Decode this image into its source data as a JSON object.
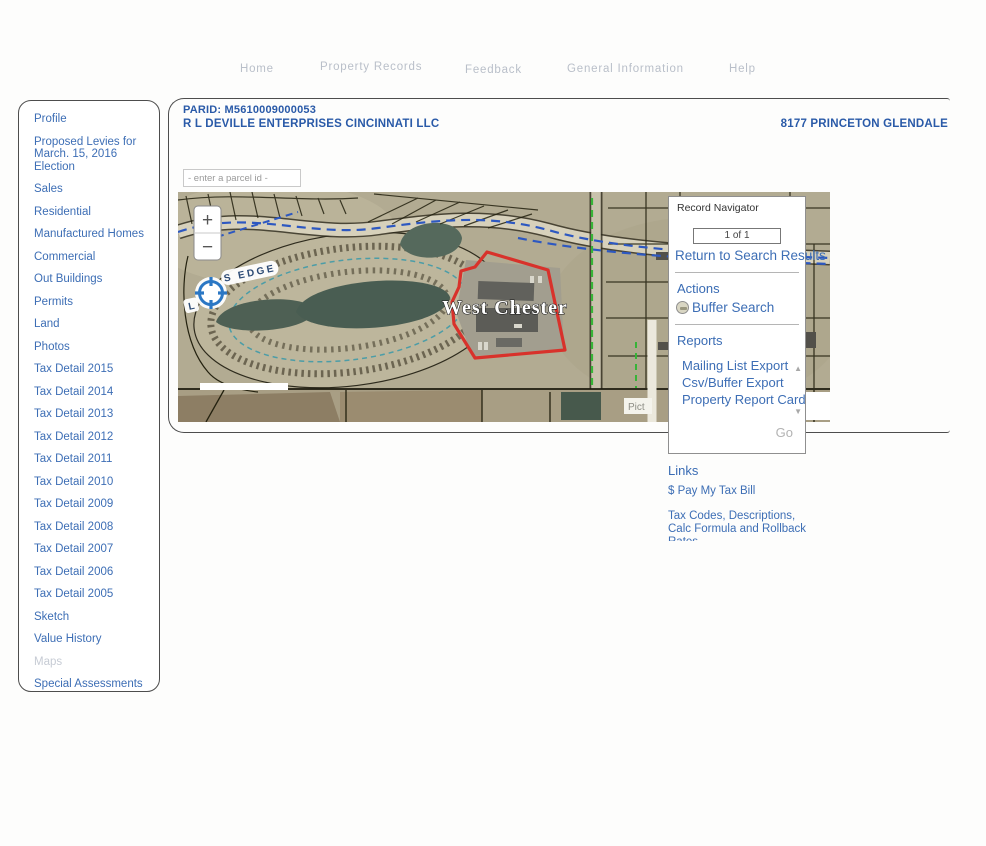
{
  "nav": {
    "items": [
      "Home",
      "Property Records",
      "Feedback",
      "General Information",
      "Help"
    ]
  },
  "sidebar": {
    "items": [
      {
        "label": "Profile"
      },
      {
        "label": "Proposed Levies for March. 15, 2016 Election"
      },
      {
        "label": "Sales"
      },
      {
        "label": "Residential"
      },
      {
        "label": "Manufactured Homes"
      },
      {
        "label": "Commercial"
      },
      {
        "label": "Out Buildings"
      },
      {
        "label": "Permits"
      },
      {
        "label": "Land"
      },
      {
        "label": "Photos"
      },
      {
        "label": "Tax Detail 2015"
      },
      {
        "label": "Tax Detail 2014"
      },
      {
        "label": "Tax Detail 2013"
      },
      {
        "label": "Tax Detail 2012"
      },
      {
        "label": "Tax Detail 2011"
      },
      {
        "label": "Tax Detail 2010"
      },
      {
        "label": "Tax Detail 2009"
      },
      {
        "label": "Tax Detail 2008"
      },
      {
        "label": "Tax Detail 2007"
      },
      {
        "label": "Tax Detail 2006"
      },
      {
        "label": "Tax Detail 2005"
      },
      {
        "label": "Sketch"
      },
      {
        "label": "Value History"
      },
      {
        "label": "Maps",
        "disabled": true
      },
      {
        "label": "Special Assessments"
      }
    ]
  },
  "header": {
    "parid": "PARID: M5610009000053",
    "owner": "R L DEVILLE ENTERPRISES CINCINNATI LLC",
    "address": "8177 PRINCETON GLENDALE"
  },
  "parcel_search": {
    "placeholder": "- enter a parcel id -"
  },
  "map": {
    "place_label": "West Chester",
    "street_prefix": "L",
    "street_label": "S EDGE",
    "attribution": "Pict"
  },
  "icons": {
    "zoom_in": "+",
    "zoom_out": "−",
    "scroll_up": "▲",
    "scroll_down": "▼"
  },
  "record_navigator": {
    "title": "Record Navigator",
    "position": "1 of 1",
    "return_link": "Return to Search Results",
    "actions_title": "Actions",
    "buffer_search": "Buffer Search",
    "reports_title": "Reports",
    "report_items": [
      "Mailing List Export",
      "Csv/Buffer Export",
      "Property Report Card"
    ],
    "go_label": "Go"
  },
  "links": {
    "title": "Links",
    "pay_tax": "$ Pay My Tax Bill",
    "tax_codes_line1": "Tax Codes, Descriptions,",
    "tax_codes_line2": "Calc Formula and Rollback",
    "tax_codes_line3": "Rates"
  },
  "colors": {
    "link_blue": "#3d6eb5",
    "header_blue": "#2a5aa8",
    "nav_gray": "#b9bfc9",
    "parcel_outline_red": "#d8322b",
    "disabled_gray": "#c6cbd4"
  }
}
